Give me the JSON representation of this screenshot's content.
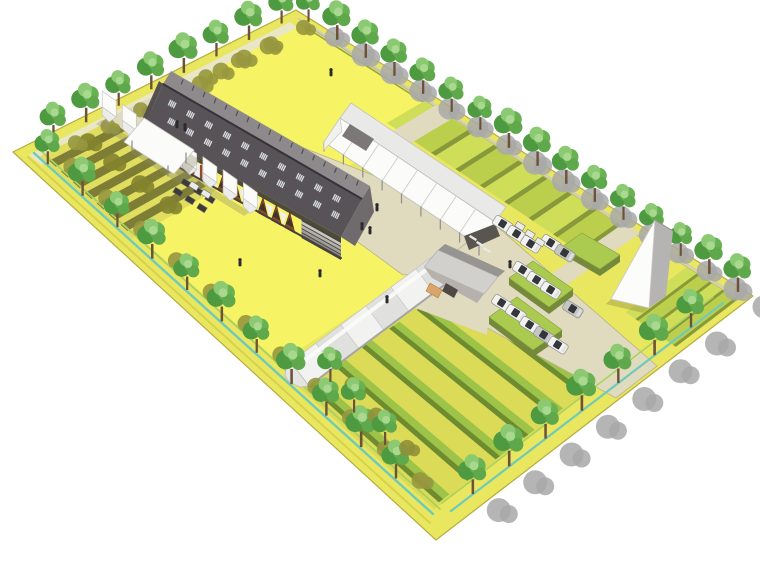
{
  "meta": {
    "description": "Aerial 3D architectural rendering of a rectangular farm campus: long dark barn with timber gable bays, row of white greenhouse tents, long white gabled greenhouse with terraced crop strips, barrel-vaulted greenhouse with hedge crop rows, small shed, white A-frame building, car parking with hedges, perimeter tree rows and drainage ditch on a white background."
  },
  "canvas": {
    "width": 760,
    "height": 570,
    "background": "#ffffff"
  },
  "palette": {
    "verge_yellow": "#e9e65f",
    "lawn_yellow": "#f6f364",
    "field_base": "#e0dd5f",
    "bottom_field": "#dbdb58",
    "stripe_dark": "#7d7d36",
    "terrace_light": "#cede58",
    "terrace_mid": "#bccf4c",
    "terrace_riser": "#87993a",
    "crop_row_bright": "#9dc348",
    "crop_row_dark": "#6d8c30",
    "road": "#e0dabe",
    "road_edge": "#b9b48f",
    "path_pale": "#eae7c6",
    "curb": "#cfccc0",
    "ditch_teal": "#6fcab8",
    "ditch_green": "#a9d160",
    "ditch_yellow": "#d8d24b",
    "boundary": "#b5ad3e",
    "shadow_olive": "#97973f",
    "shadow_olive_dark": "#83832f",
    "shadow_gray": "#a8a8a8",
    "tree_trunk": "#6d5238",
    "tree_green_1": "#4e9a41",
    "tree_green_2": "#69b254",
    "tree_green_3": "#8cc973",
    "tree_green_4": "#a8d98f",
    "tree_green_5": "#5fa84b",
    "barn_roof_dark": "#585357",
    "barn_roof_light": "#8e8a8c",
    "barn_ridge": "#35333a",
    "barn_skylight": "#d6dade",
    "barn_vent": "#504d54",
    "barn_shadow": "#3d3936",
    "barn_brown": "#8d4a2c",
    "barn_brown_dark": "#40332b",
    "barn_awning": "#efefec",
    "barn_gable": "#6f6b6d",
    "barn_plinth": "#45413c",
    "step_1": "#c9c6c2",
    "step_2": "#b5b2ae",
    "step_3": "#a19e9a",
    "step_4": "#8d8a86",
    "white_roof": "#fbfbf9",
    "white_roof_shade": "#ececea",
    "white_stroke": "#c5c5c3",
    "gh_ne_plane": "#e9e9e7",
    "gh_panel_line": "#d0d0ce",
    "gh_post": "#8f8f8d",
    "gh_dark_interior": "#59554f",
    "annex_gray": "#7b7876",
    "barrel_light": "#f2f2f0",
    "barrel_mid": "#e0e0de",
    "barrel_edge": "#a5a5a3",
    "shed_roof_light": "#d2d0cd",
    "shed_roof_dark": "#979592",
    "shed_face": "#b5b1ad",
    "shed_opening": "#4e4944",
    "shed_tan": "#d8a66b",
    "aframe_face": "#fcfcfa",
    "aframe_roof": "#b5b4b2",
    "hedge_top": "#abcb50",
    "hedge_side": "#75893a",
    "car_body": "#f2f2f0",
    "car_gray": "#c6c6c4",
    "car_glass": "#33373c",
    "table_dark": "#3c3b39",
    "table_white": "#ebebe9",
    "person": "#2b2b2b"
  },
  "scene": {
    "site": {
      "shape": "rotated rectangle on white ground",
      "edges": "tree-lined with drainage ditch"
    },
    "counts": {
      "tents": 8,
      "greenhouse_panels": 8,
      "barrel_segments": 6,
      "barn_big_bays": 6,
      "barn_small_bays": 8,
      "barn_skylight_groups": 10,
      "nw_field_stripes": 7,
      "terrace_strips": 8,
      "terrace_strips_east": 4,
      "crop_rows": 6,
      "hedge_blocks": 3,
      "parking_cars": 14,
      "people": 10
    },
    "trees": {
      "northeast": 16,
      "northwest": 8,
      "southwest": 11,
      "southeast": 7,
      "inner_field": 3
    },
    "buildings": [
      {
        "id": "main-barn",
        "label": "long barn, dark roof, skylight strips, timber A-frame bays, bleacher end"
      },
      {
        "id": "tent-row",
        "label": "row of white greenhouse tents"
      },
      {
        "id": "long-greenhouse",
        "label": "long white gabled greenhouse canopy"
      },
      {
        "id": "barrel-greenhouse",
        "label": "barrel-vaulted greenhouse"
      },
      {
        "id": "farm-shed",
        "label": "small gabled shed with tan door"
      },
      {
        "id": "a-frame-building",
        "label": "white A-frame building"
      },
      {
        "id": "cafe-pavilion",
        "label": "open pavilion with tables"
      }
    ]
  }
}
